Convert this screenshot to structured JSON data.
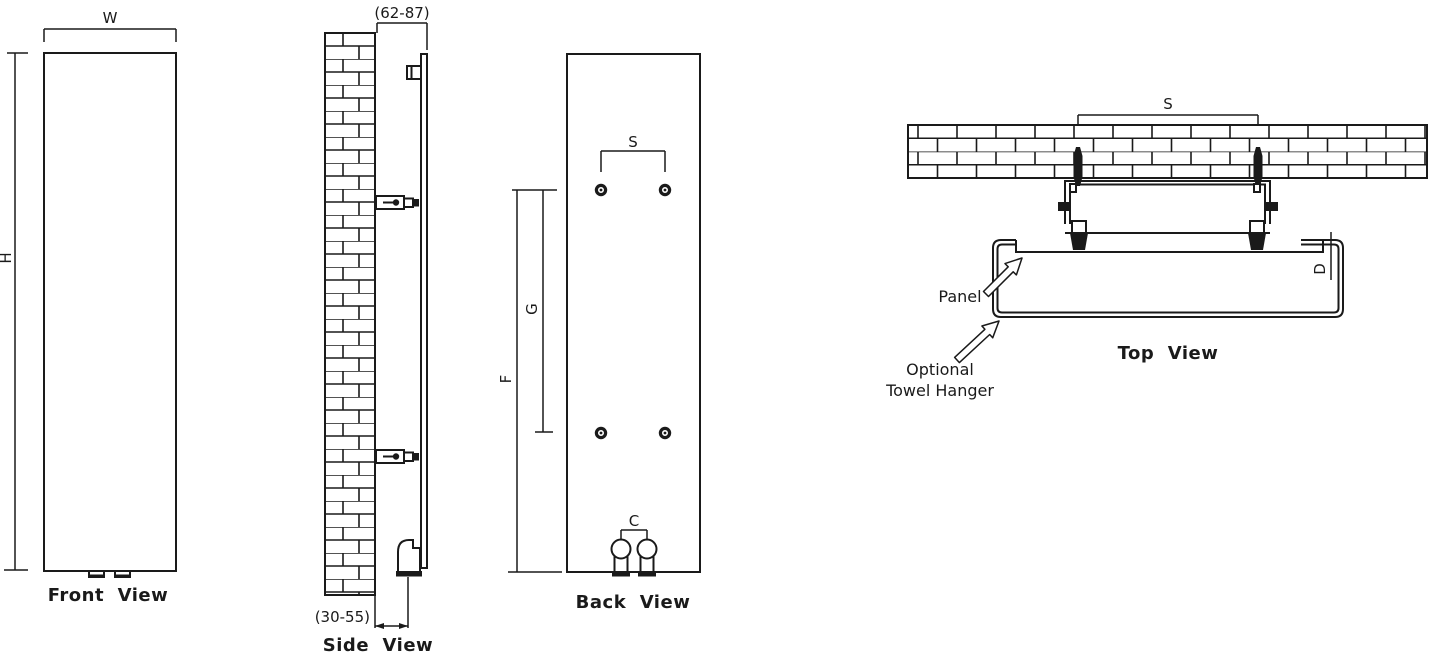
{
  "diagram": {
    "front_view": {
      "label": "Front  View",
      "width_dim": "W",
      "height_dim": "H"
    },
    "side_view": {
      "label": "Side  View",
      "top_range_dim": "(62-87)",
      "bottom_range_dim": "(30-55)"
    },
    "back_view": {
      "label": "Back  View",
      "hole_spacing_dim": "S",
      "upper_span_dim": "G",
      "full_span_dim": "F",
      "pipe_spacing_dim": "C"
    },
    "top_view": {
      "label": "Top  View",
      "anchor_spacing_dim": "S",
      "depth_dim": "D",
      "panel_callout": "Panel",
      "towel_callout_line1": "Optional",
      "towel_callout_line2": "Towel Hanger"
    }
  },
  "colors": {
    "line": "#1a1a1a",
    "background": "#ffffff"
  }
}
